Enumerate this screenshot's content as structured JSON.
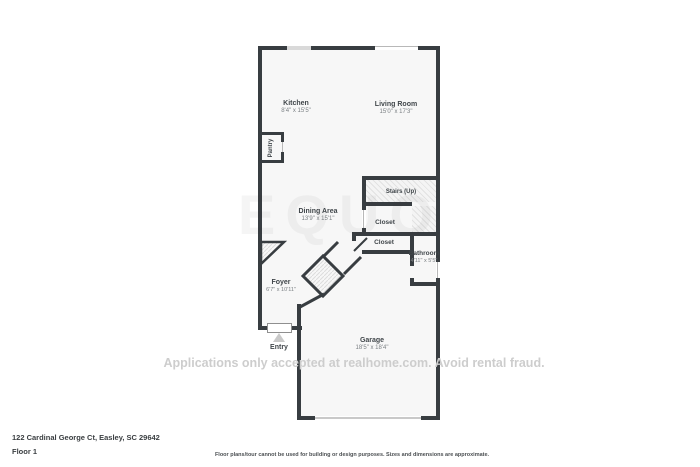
{
  "plan": {
    "rooms": [
      {
        "name": "Kitchen",
        "dims": "8'4\" x 15'5\""
      },
      {
        "name": "Living Room",
        "dims": "15'0\" x 17'3\""
      },
      {
        "name": "Pantry",
        "dims": ""
      },
      {
        "name": "Stairs (Up)",
        "dims": ""
      },
      {
        "name": "Dining Area",
        "dims": "13'9\" x 15'1\""
      },
      {
        "name": "Closet",
        "dims": ""
      },
      {
        "name": "Closet",
        "dims": ""
      },
      {
        "name": "Bathroom",
        "dims": "4'11\" x 5'5\""
      },
      {
        "name": "Foyer",
        "dims": "6'7\" x 10'11\""
      },
      {
        "name": "Entry",
        "dims": ""
      },
      {
        "name": "Garage",
        "dims": "18'5\" x 18'4\""
      }
    ]
  },
  "watermark": {
    "text": "Applications only accepted at realhome.com. Avoid rental fraud.",
    "logo": "EQUO"
  },
  "footer": {
    "address": "122 Cardinal George Ct, Easley, SC 29642",
    "floor_label": "Floor 1",
    "disclaimer": "Floor plans/tour cannot be used for building or design purposes. Sizes and dimensions are approximate."
  },
  "colors": {
    "wall": "#383d41",
    "floor": "#f7f7f7",
    "hatch_line": "#e2e2e2",
    "watermark_text": "#cdcdcd"
  }
}
